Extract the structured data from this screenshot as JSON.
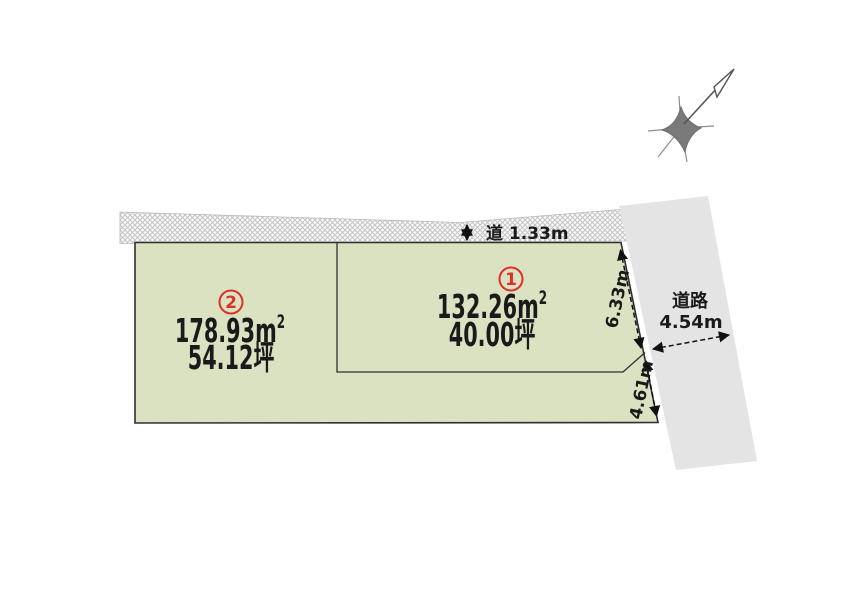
{
  "diagram": {
    "top_road": {
      "label": "道 1.33m"
    },
    "side_road": {
      "name": "道路",
      "width": "4.54m"
    },
    "dimensions": {
      "upper_edge": "6.33m",
      "lower_edge": "4.61m"
    },
    "plots": [
      {
        "number": "1",
        "area_value": "132.26",
        "unit_base": "m",
        "unit_sup": "2",
        "tsubo": "40.00坪"
      },
      {
        "number": "2",
        "area_value": "178.93",
        "unit_base": "m",
        "unit_sup": "2",
        "tsubo": "54.12坪"
      }
    ],
    "colors": {
      "plot_fill": "#dbe2c2",
      "plot_border": "#2f2f2f",
      "side_road_fill": "#e4e4e4",
      "hatch_line": "#c4c4c4",
      "accent_red": "#dd3128",
      "text": "#1a1a1a"
    }
  }
}
